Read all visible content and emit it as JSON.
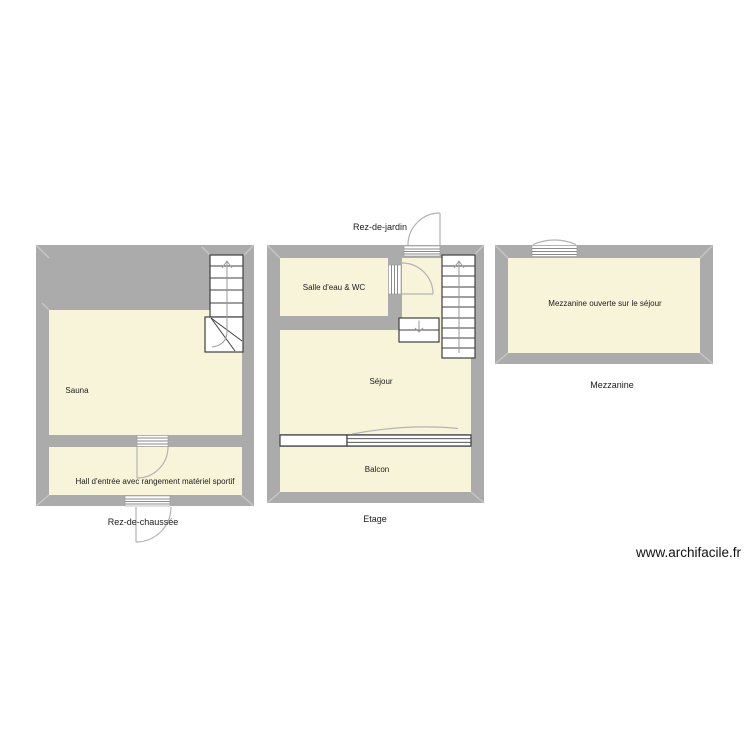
{
  "page": {
    "watermark": "www.archifacile.fr"
  },
  "colors": {
    "wall": "#ababab",
    "room_fill": "#f8f4da",
    "symbol_stroke": "#3f3f3f",
    "door_stroke": "#b3b3b3",
    "text": "#1c1c1c"
  },
  "plans": [
    {
      "name": "Rez-de-chaussée",
      "rooms": [
        {
          "label": "Sauna"
        },
        {
          "label": "Hall d'entrée avec rangement matériel sportif"
        }
      ]
    },
    {
      "name": "Etage",
      "exterior_label": "Rez-de-jardin",
      "rooms": [
        {
          "label": "Salle d'eau & WC"
        },
        {
          "label": "Séjour"
        },
        {
          "label": "Balcon"
        }
      ]
    },
    {
      "name": "Mezzanine",
      "rooms": [
        {
          "label": "Mezzanine ouverte sur le séjour"
        }
      ]
    }
  ]
}
